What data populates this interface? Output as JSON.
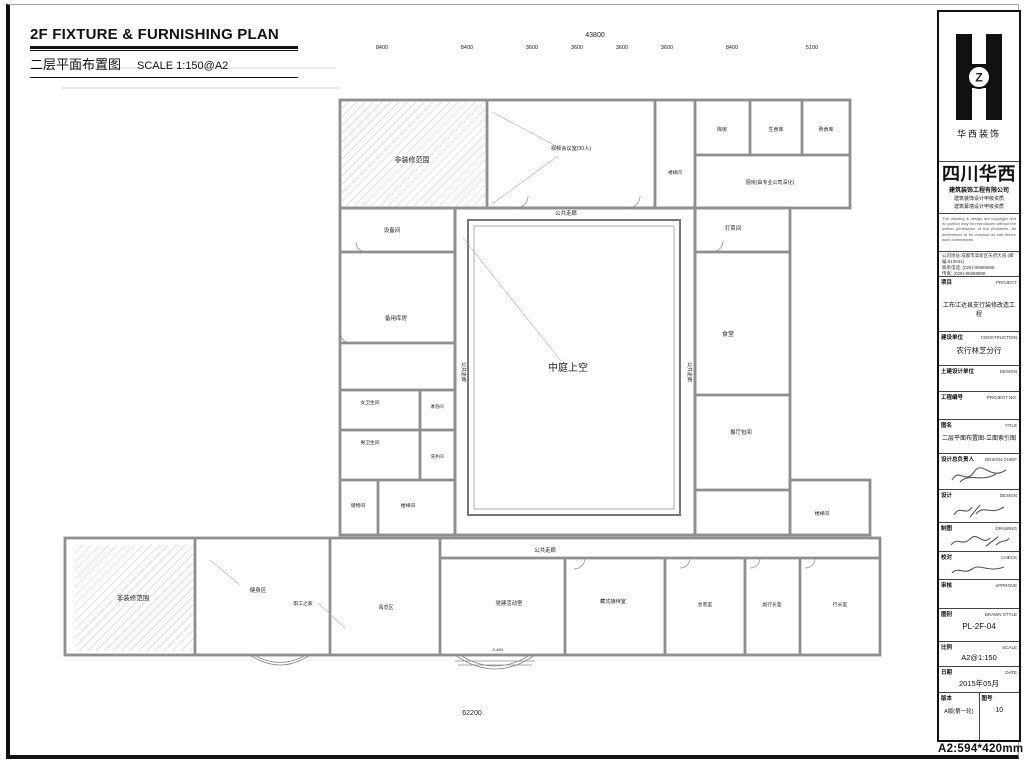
{
  "sheet": {
    "title_en": "2F  FIXTURE & FURNISHING PLAN",
    "title_cn": "二层平面布置图",
    "scale_note": "SCALE  1:150@A2",
    "paper_note": "A2:594*420mm"
  },
  "plan": {
    "rooms": {
      "non_deco": "非装修范围",
      "video_conf": "视频会议室(30人)",
      "store_top": "库房",
      "raw_food": "生食库",
      "cooked_food": "熟食库",
      "kitchen": "厨房(由专业公司深化)",
      "stair": "楼梯间",
      "equipment": "设备间",
      "backup_store": "备用库房",
      "female_wc": "女卫生间",
      "male_wc": "男卫生间",
      "shower": "淋浴间",
      "washroom": "洗手间",
      "storage": "储物间",
      "atrium": "中庭上空",
      "corridor": "公共走廊",
      "serving": "打菜间",
      "canteen": "食堂",
      "private_dining": "餐厅包间",
      "fitness": "健身区",
      "staff_home": "职工之家",
      "reading": "阅览区",
      "party_room": "党建活动室",
      "tibetan_room": "藏式接待室",
      "reception": "会客室",
      "deputy_office": "副行长室",
      "manager_office": "行长室"
    },
    "level_note": "-0.450",
    "dims": {
      "top_total": "43800",
      "top_segments": [
        "8400",
        "8400",
        "3600",
        "3600",
        "3600",
        "3600",
        "8400",
        "5100"
      ],
      "bottom_total": "62200",
      "bottom_segment": "3600",
      "left": [
        "3650",
        "4750",
        "3600",
        "3600",
        "8950"
      ],
      "right": [
        "3650",
        "4750",
        "3600",
        "3600",
        "8950"
      ]
    },
    "markers": {
      "a": "A",
      "b": "B",
      "c": "C",
      "d": "D",
      "e": "E",
      "f": "F"
    }
  },
  "titleblock": {
    "logo_caption": "华西装饰",
    "logo_letter": "Z",
    "company_name": "四川华西",
    "company_line1": "建筑装饰工程有限公司",
    "company_cert1": "建筑装饰设计甲级资质",
    "company_cert2": "建筑幕墙设计甲级资质",
    "notice": "The drawing & design are copyright and no portion may be reproduced without the written permission of the Architects. All dimensions to be checked on site before work commences.",
    "address": "公司地址:成都市高新区天府大道 (邮编:610041)",
    "phone": "联系电话: (028)-85988888",
    "fax": "传真: (028)-85988888",
    "project": {
      "label": "项目",
      "label_en": "PROJECT",
      "value": "工布江达县支行装修改造工程"
    },
    "construction": {
      "label": "建设单位",
      "label_en": "CONSTRUCTION",
      "value": "农行林芝分行"
    },
    "civil_design": {
      "label": "土建设计单位",
      "label_en": "DESIGN",
      "value": ""
    },
    "project_no": {
      "label": "工程编号",
      "label_en": "PROJECT NO.",
      "value": ""
    },
    "drawing_title": {
      "label": "图名",
      "label_en": "TITLE",
      "value": "二层平面布置图-立面索引图"
    },
    "design_chief": {
      "label": "设计总负责人",
      "label_en": "DESIGN CHIEF",
      "value": ""
    },
    "design": {
      "label": "设计",
      "label_en": "DESIGN",
      "value": ""
    },
    "drafting": {
      "label": "制图",
      "label_en": "DRAWING",
      "value": ""
    },
    "check": {
      "label": "校对",
      "label_en": "CHECK",
      "value": ""
    },
    "approve": {
      "label": "审核",
      "label_en": "APPROVE",
      "value": ""
    },
    "draw_style": {
      "label": "图别",
      "label_en": "DRAWN STYLE",
      "value": "PL-2F-04"
    },
    "scale": {
      "label": "比例",
      "label_en": "SCALE",
      "value": "A2@1:150"
    },
    "date": {
      "label": "日期",
      "label_en": "DATE",
      "value": "2015年05月"
    },
    "version": {
      "label": "版本",
      "value": "A版(第一轮)"
    },
    "sheet_no": {
      "label": "图号",
      "value": "10"
    }
  }
}
